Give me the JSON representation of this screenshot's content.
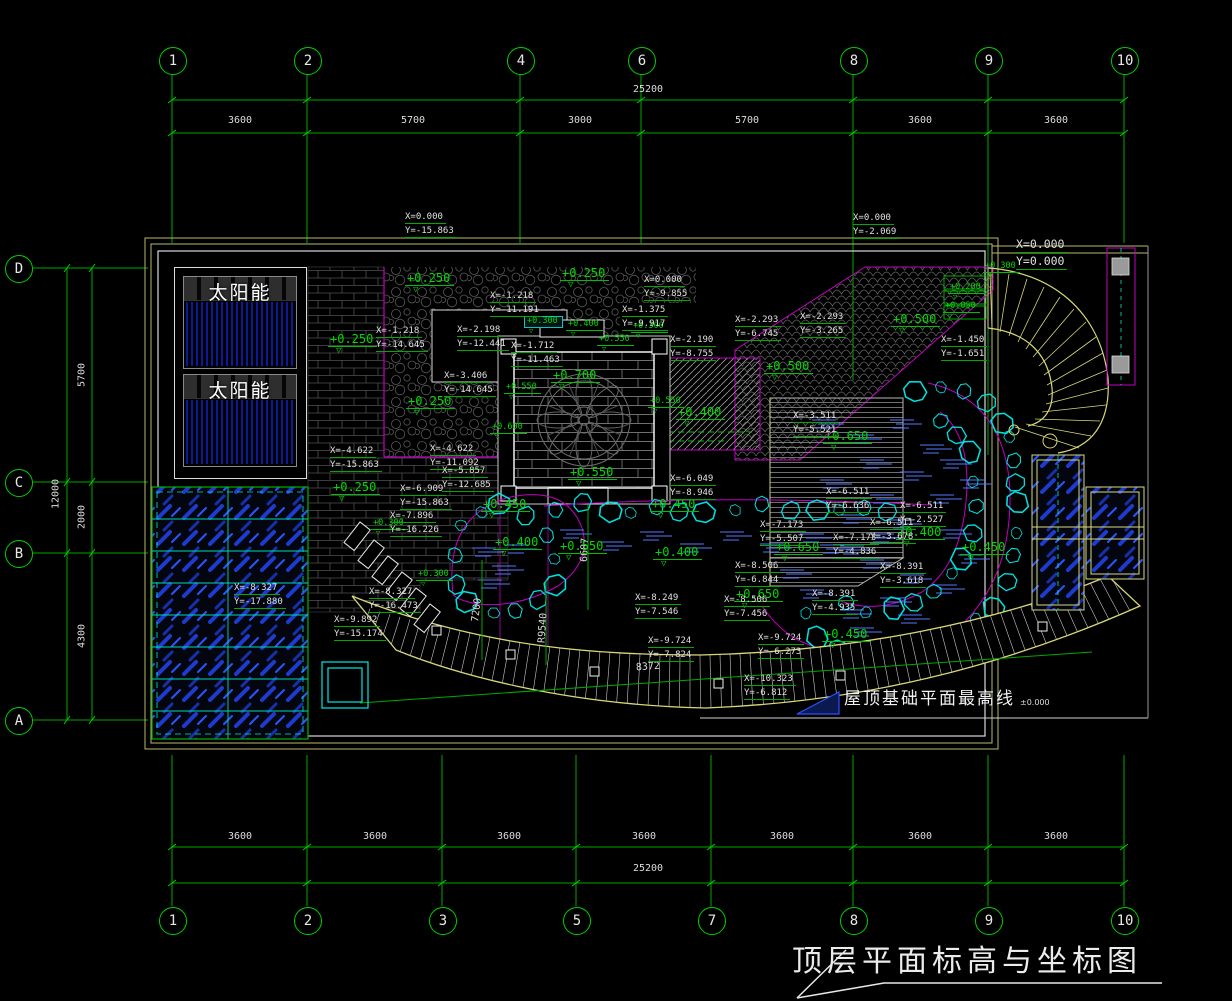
{
  "drawing_title": "顶层平面标高与坐标图",
  "roof_note": {
    "label": "屋顶基础平面最高线",
    "value": "±0.000"
  },
  "solar_panel_label": "太阳能",
  "colors": {
    "line_green": "#00bf00",
    "text_green": "#00d800",
    "white": "#e8e8e8",
    "magenta": "#cc00cc",
    "cyan": "#00e5e5",
    "yellow": "#d8d878",
    "glass_blue": "#1e3bd0",
    "water_blue": "#5577ff"
  },
  "grid": {
    "top": {
      "total_label": "25200",
      "bubbles": [
        {
          "label": "1",
          "x": 172
        },
        {
          "label": "2",
          "x": 307
        },
        {
          "label": "4",
          "x": 520
        },
        {
          "label": "6",
          "x": 641
        },
        {
          "label": "8",
          "x": 853
        },
        {
          "label": "9",
          "x": 988
        },
        {
          "label": "10",
          "x": 1124
        }
      ],
      "segments": [
        {
          "label": "3600",
          "x": 240
        },
        {
          "label": "5700",
          "x": 413
        },
        {
          "label": "3000",
          "x": 580
        },
        {
          "label": "5700",
          "x": 747
        },
        {
          "label": "3600",
          "x": 920
        },
        {
          "label": "3600",
          "x": 1056
        }
      ]
    },
    "bottom": {
      "total_label": "25200",
      "bubbles": [
        {
          "label": "1",
          "x": 172
        },
        {
          "label": "2",
          "x": 307
        },
        {
          "label": "3",
          "x": 442
        },
        {
          "label": "5",
          "x": 576
        },
        {
          "label": "7",
          "x": 711
        },
        {
          "label": "8",
          "x": 853
        },
        {
          "label": "9",
          "x": 988
        },
        {
          "label": "10",
          "x": 1124
        }
      ],
      "segments": [
        {
          "label": "3600",
          "x": 240
        },
        {
          "label": "3600",
          "x": 375
        },
        {
          "label": "3600",
          "x": 509
        },
        {
          "label": "3600",
          "x": 644
        },
        {
          "label": "3600",
          "x": 782
        },
        {
          "label": "3600",
          "x": 920
        },
        {
          "label": "3600",
          "x": 1056
        }
      ]
    },
    "left": {
      "total_label": "12000",
      "bubbles": [
        {
          "label": "D",
          "y": 268
        },
        {
          "label": "C",
          "y": 482
        },
        {
          "label": "B",
          "y": 553
        },
        {
          "label": "A",
          "y": 720
        }
      ],
      "segments": [
        {
          "label": "5700",
          "y": 375
        },
        {
          "label": "2000",
          "y": 517
        },
        {
          "label": "4300",
          "y": 636
        }
      ]
    }
  },
  "elevations": [
    {
      "t": "+0.250",
      "x": 405,
      "y": 272
    },
    {
      "t": "+0.250",
      "x": 560,
      "y": 267
    },
    {
      "t": "+0.250",
      "x": 328,
      "y": 333
    },
    {
      "t": "+0.250",
      "x": 406,
      "y": 395
    },
    {
      "t": "+0.250",
      "x": 331,
      "y": 481
    },
    {
      "t": "+0.700",
      "x": 551,
      "y": 369
    },
    {
      "t": "+0.550",
      "x": 568,
      "y": 466
    },
    {
      "t": "+0.400",
      "x": 676,
      "y": 406
    },
    {
      "t": "+0.500",
      "x": 764,
      "y": 360
    },
    {
      "t": "+0.500",
      "x": 891,
      "y": 313
    },
    {
      "t": "+0.650",
      "x": 823,
      "y": 430
    },
    {
      "t": "+0.650",
      "x": 774,
      "y": 541
    },
    {
      "t": "+0.650",
      "x": 734,
      "y": 588
    },
    {
      "t": "+0.450",
      "x": 481,
      "y": 498
    },
    {
      "t": "+0.450",
      "x": 650,
      "y": 498
    },
    {
      "t": "+0.400",
      "x": 493,
      "y": 536
    },
    {
      "t": "+0.550",
      "x": 558,
      "y": 540
    },
    {
      "t": "+0.400",
      "x": 653,
      "y": 546
    },
    {
      "t": "+0.400",
      "x": 896,
      "y": 526
    },
    {
      "t": "+0.450",
      "x": 822,
      "y": 628
    },
    {
      "t": "+0.450",
      "x": 960,
      "y": 541
    },
    {
      "t": "+0.300",
      "x": 524,
      "y": 316,
      "c": "sm boxed"
    },
    {
      "t": "+0.400",
      "x": 566,
      "y": 320,
      "c": "sm"
    },
    {
      "t": "+0.550",
      "x": 597,
      "y": 335,
      "c": "sm"
    },
    {
      "t": "+0.300",
      "x": 631,
      "y": 322,
      "c": "sm"
    },
    {
      "t": "+0.550",
      "x": 504,
      "y": 383,
      "c": "sm"
    },
    {
      "t": "+0.600",
      "x": 490,
      "y": 423,
      "c": "sm"
    },
    {
      "t": "+0.550",
      "x": 648,
      "y": 397,
      "c": "sm"
    },
    {
      "t": "+0.300",
      "x": 371,
      "y": 519,
      "c": "sm"
    },
    {
      "t": "+0.300",
      "x": 416,
      "y": 570,
      "c": "sm"
    },
    {
      "t": "+0.300",
      "x": 983,
      "y": 262,
      "c": "sm"
    },
    {
      "t": "+0.200",
      "x": 948,
      "y": 283,
      "c": "sm"
    },
    {
      "t": "+0.050",
      "x": 943,
      "y": 302,
      "c": "sm"
    }
  ],
  "coords": [
    {
      "xt": "X=0.000",
      "yt": "Y=-15.863",
      "x": 405,
      "y": 212
    },
    {
      "xt": "X=0.000",
      "yt": "Y=-2.069",
      "x": 853,
      "y": 213
    },
    {
      "xt": "X=0.000",
      "yt": "Y=0.000",
      "x": 1016,
      "y": 238,
      "c": "datum"
    },
    {
      "xt": "X=-1.218",
      "yt": "Y=-11.191",
      "x": 490,
      "y": 291
    },
    {
      "xt": "X=-1.218",
      "yt": "Y=-14.645",
      "x": 376,
      "y": 326
    },
    {
      "xt": "X=-2.198",
      "yt": "Y=-12.441",
      "x": 457,
      "y": 325
    },
    {
      "xt": "X=-1.712",
      "yt": "Y=-11.463",
      "x": 511,
      "y": 341
    },
    {
      "xt": "X=-3.406",
      "yt": "Y=-14.645",
      "x": 444,
      "y": 371
    },
    {
      "xt": "X=0.000",
      "yt": "Y=-9.855",
      "x": 644,
      "y": 275
    },
    {
      "xt": "X=-1.375",
      "yt": "Y=-9.917",
      "x": 622,
      "y": 305
    },
    {
      "xt": "X=-2.190",
      "yt": "Y=-8.755",
      "x": 670,
      "y": 335
    },
    {
      "xt": "X=-2.293",
      "yt": "Y=-6.745",
      "x": 735,
      "y": 315
    },
    {
      "xt": "X=-2.293",
      "yt": "Y=-3.265",
      "x": 800,
      "y": 312
    },
    {
      "xt": "X=-1.450",
      "yt": "Y=-1.651",
      "x": 941,
      "y": 335
    },
    {
      "xt": "X=-3.511",
      "yt": "Y=-5.521",
      "x": 793,
      "y": 411
    },
    {
      "xt": "X=-4.622",
      "yt": "Y=-15.863",
      "x": 330,
      "y": 446
    },
    {
      "xt": "X=-4.622",
      "yt": "Y=-11.092",
      "x": 430,
      "y": 444
    },
    {
      "xt": "X=-5.857",
      "yt": "Y=-12.685",
      "x": 442,
      "y": 466
    },
    {
      "xt": "X=-6.909",
      "yt": "Y=-15.863",
      "x": 400,
      "y": 484
    },
    {
      "xt": "X=-7.896",
      "yt": "Y=-16.226",
      "x": 390,
      "y": 511
    },
    {
      "xt": "X=-8.327",
      "yt": "Y=-16.473",
      "x": 369,
      "y": 587
    },
    {
      "xt": "X=-9.892",
      "yt": "Y=-15.174",
      "x": 334,
      "y": 615
    },
    {
      "xt": "X=-8.327",
      "yt": "Y=-17.880",
      "x": 234,
      "y": 583
    },
    {
      "xt": "X=-6.049",
      "yt": "Y=-8.946",
      "x": 670,
      "y": 474
    },
    {
      "xt": "X=-6.511",
      "yt": "Y=-6.636",
      "x": 826,
      "y": 487
    },
    {
      "xt": "X=-6.511",
      "yt": "Y=-2.527",
      "x": 900,
      "y": 501
    },
    {
      "xt": "X=-6.511",
      "yt": "Y=-3.678",
      "x": 870,
      "y": 518
    },
    {
      "xt": "X=-7.173",
      "yt": "Y=-5.507",
      "x": 760,
      "y": 520
    },
    {
      "xt": "X=-7.173",
      "yt": "Y=-4.836",
      "x": 833,
      "y": 533
    },
    {
      "xt": "X=-8.391",
      "yt": "Y=-3.618",
      "x": 880,
      "y": 562
    },
    {
      "xt": "X=-8.391",
      "yt": "Y=-4.935",
      "x": 812,
      "y": 589
    },
    {
      "xt": "X=-8.506",
      "yt": "Y=-6.844",
      "x": 735,
      "y": 561
    },
    {
      "xt": "X=-8.506",
      "yt": "Y=-7.456",
      "x": 724,
      "y": 595
    },
    {
      "xt": "X=-8.249",
      "yt": "Y=-7.546",
      "x": 635,
      "y": 593
    },
    {
      "xt": "X=-9.724",
      "yt": "Y=-7.824",
      "x": 648,
      "y": 636
    },
    {
      "xt": "X=-9.724",
      "yt": "Y=-6.273",
      "x": 758,
      "y": 633
    },
    {
      "xt": "X=-10.323",
      "yt": "Y=-6.812",
      "x": 744,
      "y": 674
    }
  ],
  "dims": [
    {
      "t": "8372",
      "x": 648,
      "y": 667,
      "r": -4
    },
    {
      "t": "6687",
      "x": 585,
      "y": 550,
      "r": -87
    },
    {
      "t": "7200",
      "x": 477,
      "y": 610,
      "r": -83
    },
    {
      "t": "R9540",
      "x": 543,
      "y": 628,
      "r": -86
    }
  ]
}
